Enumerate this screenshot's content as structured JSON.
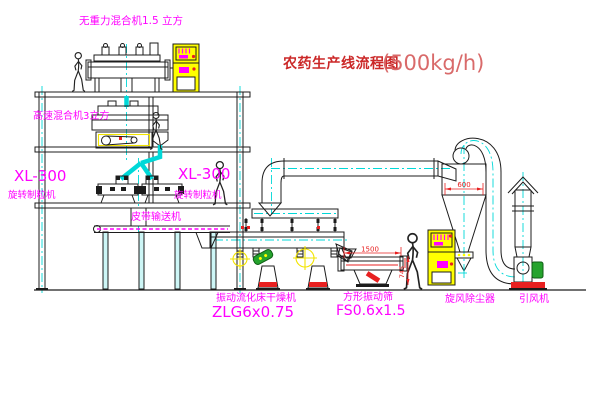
{
  "title": {
    "name": "农药生产线流程图",
    "capacity": "(500kg/h)"
  },
  "labels": {
    "gravity_free_mixer": "无重力混合机1.5 立方",
    "high_speed_mixer": "高速混合机3立方",
    "granulator_left_model": "XL-300",
    "granulator_left_name": "旋转制粒机",
    "granulator_right_model": "XL-300",
    "granulator_right_name": "旋转制粒机",
    "belt_conveyor": "皮带输送机",
    "dryer_name": "振动流化床干燥机",
    "dryer_model": "ZLG6x0.75",
    "sieve_name": "方形振动筛",
    "sieve_model": "FS0.6x1.5",
    "cyclone": "旋风除尘器",
    "fan": "引风机"
  },
  "dimensions": {
    "sieve_length": "1500",
    "sieve_height": "745",
    "cyclone_diameter": "600"
  },
  "colors": {
    "background": "#ffffff",
    "line_black": "#1c1c1c",
    "label_magenta": "#ff00ff",
    "title_red": "#cb2828",
    "capacity_red": "#d96a6a",
    "dimension_red": "#e82020",
    "centerline_cyan": "#00d8d8",
    "cabinet_yellow": "#ffff00",
    "motor_green": "#25a32d"
  }
}
